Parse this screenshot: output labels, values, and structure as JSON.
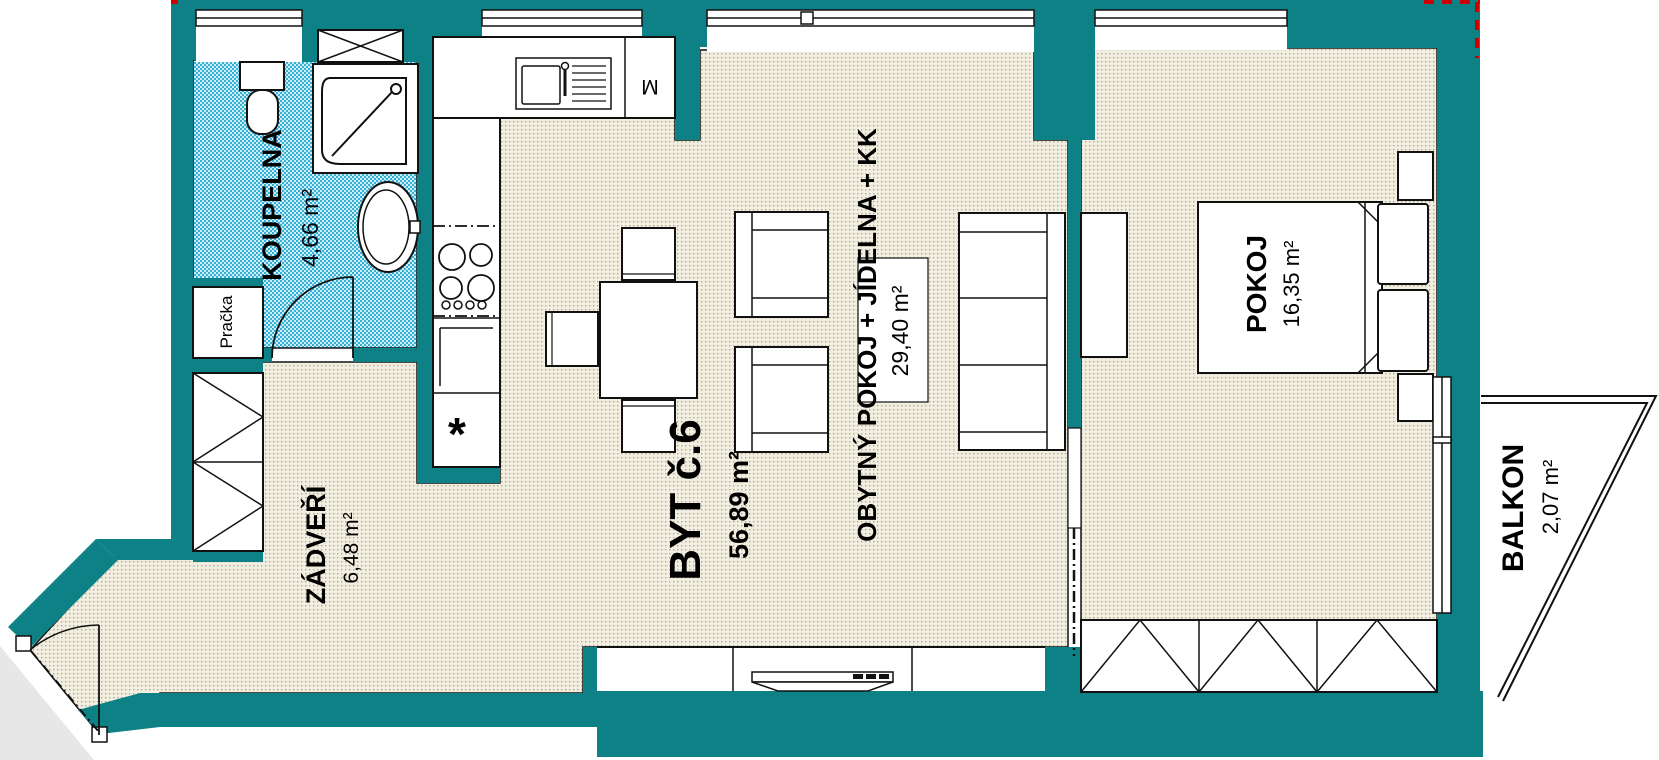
{
  "plan": {
    "title": "BYT č.6",
    "title_area": "56,89 m²",
    "rooms": [
      {
        "id": "koupelna",
        "name": "KOUPELNA",
        "area": "4,66 m²"
      },
      {
        "id": "zadveri",
        "name": "ZÁDVEŘÍ",
        "area": "6,48 m²"
      },
      {
        "id": "obytny",
        "name": "OBYTNÝ POKOJ + JÍDELNA + KK",
        "area": "29,40 m²"
      },
      {
        "id": "pokoj",
        "name": "POKOJ",
        "area": "16,35 m²"
      },
      {
        "id": "balkon",
        "name": "BALKON",
        "area": "2,07 m²"
      }
    ],
    "appliances": {
      "washer": "Pračka",
      "dishwasher": "M",
      "freezer": "*"
    },
    "colors": {
      "wall": "#0d8186",
      "floor_base": "#f2efe2",
      "floor_dot": "#b1a985",
      "bath_base": "#c4ebf5",
      "bath_dot": "#35b0d4",
      "outside": "#e7e7e7",
      "marker": "#cc0000"
    }
  }
}
